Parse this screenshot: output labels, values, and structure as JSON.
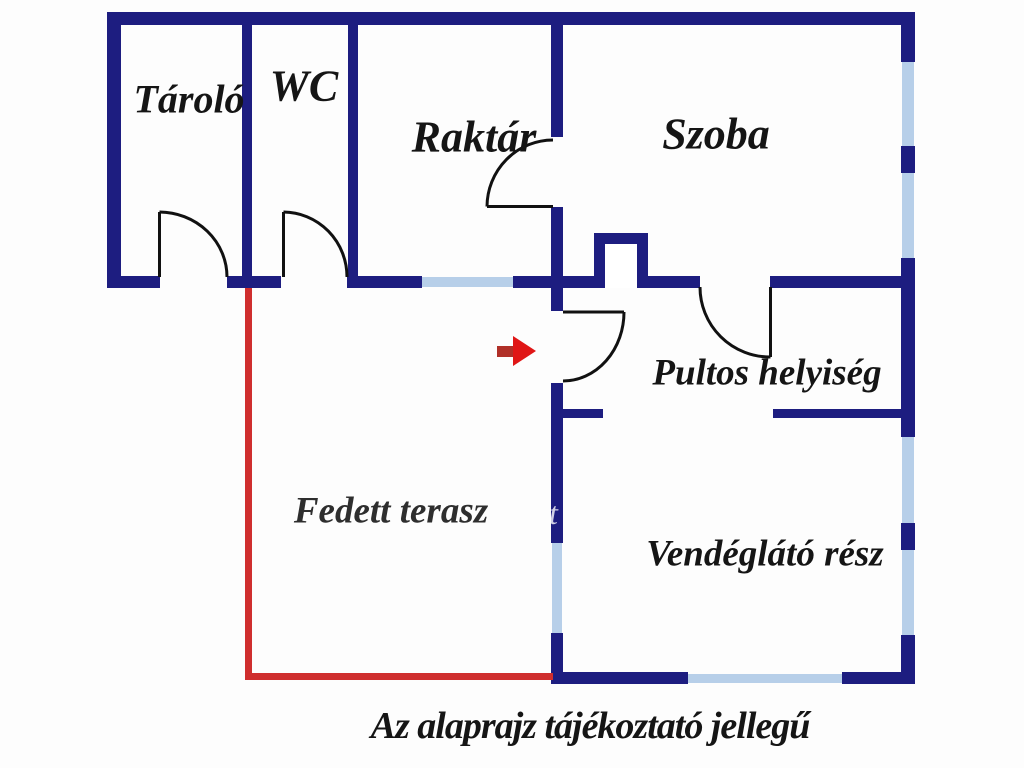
{
  "diagram": {
    "type": "floor-plan",
    "caption": "Az alaprajz tájékoztató jellegű",
    "watermark_letter": "t",
    "rooms": [
      {
        "id": "tarolo",
        "label": "Tároló"
      },
      {
        "id": "wc",
        "label": "WC"
      },
      {
        "id": "raktar",
        "label": "Raktár"
      },
      {
        "id": "szoba",
        "label": "Szoba"
      },
      {
        "id": "pultos",
        "label": "Pultos helyiség"
      },
      {
        "id": "fedett-terasz",
        "label": "Fedett terasz"
      },
      {
        "id": "vendeglato",
        "label": "Vendéglátó rész"
      }
    ],
    "colors": {
      "wall": "#1d1d80",
      "window": "#b7cfe9",
      "door": "#111111",
      "terrace_outline": "#cf2e2e",
      "arrow_head": "#e01616",
      "arrow_stem": "#b03028",
      "text": "#151515",
      "background": "#fdfdfd"
    }
  }
}
